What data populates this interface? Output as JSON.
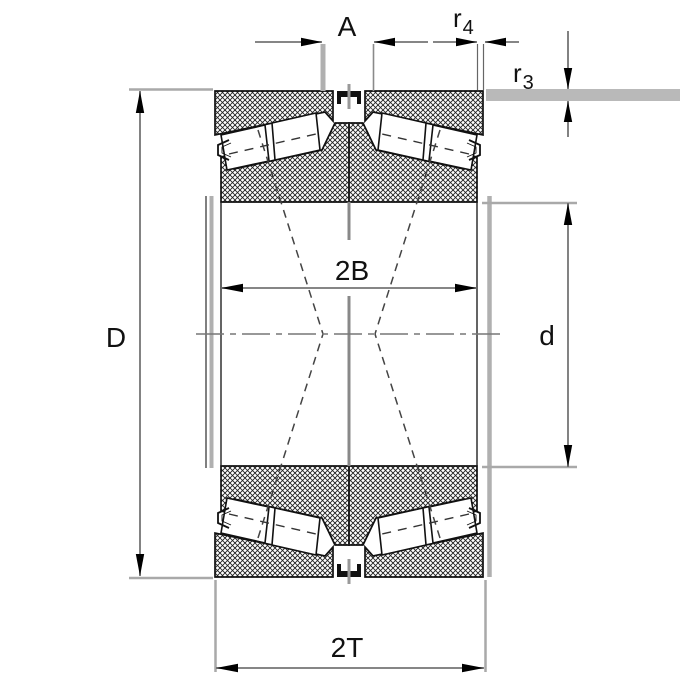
{
  "figure": {
    "type": "technical-drawing",
    "subject": "Double-row tapered roller bearing cross-section with dimension annotations"
  },
  "labels": {
    "A": "A",
    "r4": {
      "base": "r",
      "sub": "4"
    },
    "r3": {
      "base": "r",
      "sub": "3"
    },
    "D": "D",
    "d": "d",
    "inner_width": "2B",
    "total_width": "2T"
  },
  "colors": {
    "outline": "#111111",
    "dimension_line": "#757575",
    "extension_line": "#a9a9a9",
    "adjacent_part_gray": "#b5b5b5",
    "centerline_gray": "#777777",
    "background": "#ffffff"
  }
}
